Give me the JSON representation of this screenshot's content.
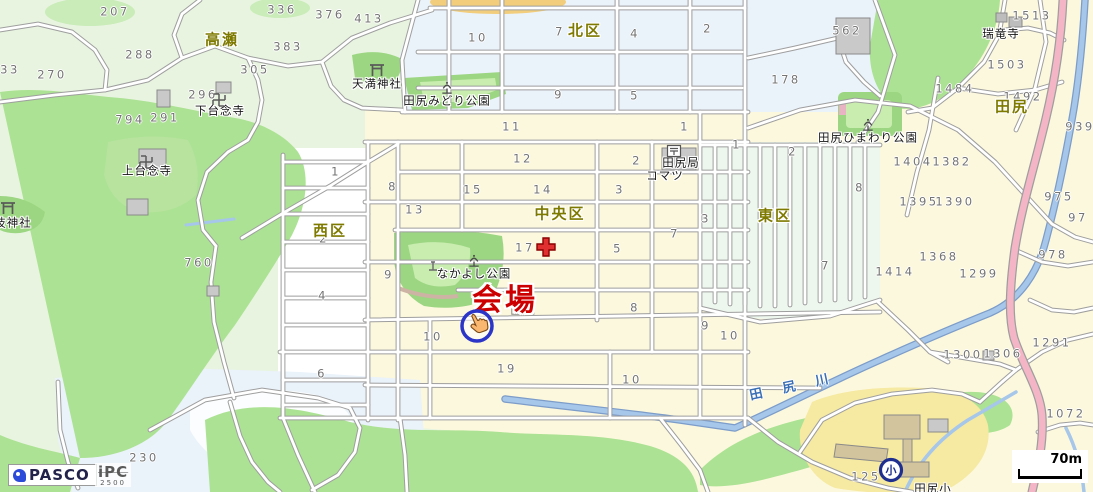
{
  "districts": [
    {
      "text": "高瀬",
      "x": 222,
      "y": 40
    },
    {
      "text": "北区",
      "x": 585,
      "y": 31
    },
    {
      "text": "西区",
      "x": 330,
      "y": 231
    },
    {
      "text": "中央区",
      "x": 560,
      "y": 214
    },
    {
      "text": "東区",
      "x": 775,
      "y": 216
    },
    {
      "text": "田尻",
      "x": 1012,
      "y": 107
    }
  ],
  "pois": [
    {
      "text": "田尻みどり公園",
      "x": 447,
      "y": 101
    },
    {
      "text": "天満神社",
      "x": 377,
      "y": 84
    },
    {
      "text": "下台念寺",
      "x": 220,
      "y": 111
    },
    {
      "text": "上台念寺",
      "x": 147,
      "y": 171
    },
    {
      "text": "技神社",
      "x": 13,
      "y": 223
    },
    {
      "text": "なかよし公園",
      "x": 474,
      "y": 274
    },
    {
      "text": "田尻ひまわり公園",
      "x": 868,
      "y": 138
    },
    {
      "text": "瑞竜寺",
      "x": 1001,
      "y": 34
    },
    {
      "text": "田尻局",
      "x": 681,
      "y": 163
    },
    {
      "text": "コマツ",
      "x": 665,
      "y": 176
    },
    {
      "text": "田尻小",
      "x": 933,
      "y": 489
    }
  ],
  "venue": {
    "label": "会場",
    "x": 505,
    "y": 301,
    "color": "#cc0000"
  },
  "river": {
    "label": "田 尻 川",
    "x": 793,
    "y": 387
  },
  "numbers": [
    {
      "t": "207",
      "x": 115,
      "y": 12
    },
    {
      "t": "336",
      "x": 282,
      "y": 10
    },
    {
      "t": "376",
      "x": 330,
      "y": 15
    },
    {
      "t": "413",
      "x": 369,
      "y": 19
    },
    {
      "t": "288",
      "x": 140,
      "y": 55
    },
    {
      "t": "383",
      "x": 288,
      "y": 47
    },
    {
      "t": "305",
      "x": 255,
      "y": 70
    },
    {
      "t": "270",
      "x": 52,
      "y": 75
    },
    {
      "t": "33",
      "x": 10,
      "y": 70
    },
    {
      "t": "296",
      "x": 203,
      "y": 95
    },
    {
      "t": "794",
      "x": 130,
      "y": 120
    },
    {
      "t": "291",
      "x": 165,
      "y": 118
    },
    {
      "t": "760",
      "x": 199,
      "y": 263
    },
    {
      "t": "230",
      "x": 144,
      "y": 458
    },
    {
      "t": "10",
      "x": 478,
      "y": 38
    },
    {
      "t": "7",
      "x": 560,
      "y": 32
    },
    {
      "t": "4",
      "x": 635,
      "y": 34
    },
    {
      "t": "2",
      "x": 708,
      "y": 29
    },
    {
      "t": "9",
      "x": 559,
      "y": 95
    },
    {
      "t": "5",
      "x": 635,
      "y": 96
    },
    {
      "t": "11",
      "x": 512,
      "y": 127
    },
    {
      "t": "1",
      "x": 685,
      "y": 127
    },
    {
      "t": "178",
      "x": 786,
      "y": 80
    },
    {
      "t": "562",
      "x": 847,
      "y": 31
    },
    {
      "t": "1513",
      "x": 1032,
      "y": 16
    },
    {
      "t": "1503",
      "x": 1007,
      "y": 65
    },
    {
      "t": "1484",
      "x": 955,
      "y": 89
    },
    {
      "t": "1492",
      "x": 1023,
      "y": 97
    },
    {
      "t": "939",
      "x": 1080,
      "y": 127
    },
    {
      "t": "12",
      "x": 523,
      "y": 159
    },
    {
      "t": "2",
      "x": 637,
      "y": 161
    },
    {
      "t": "15",
      "x": 473,
      "y": 190
    },
    {
      "t": "14",
      "x": 543,
      "y": 190
    },
    {
      "t": "3",
      "x": 620,
      "y": 190
    },
    {
      "t": "8",
      "x": 393,
      "y": 187
    },
    {
      "t": "13",
      "x": 415,
      "y": 210
    },
    {
      "t": "1",
      "x": 336,
      "y": 172
    },
    {
      "t": "2",
      "x": 324,
      "y": 239
    },
    {
      "t": "4",
      "x": 323,
      "y": 296
    },
    {
      "t": "9",
      "x": 389,
      "y": 275
    },
    {
      "t": "6",
      "x": 322,
      "y": 374
    },
    {
      "t": "17",
      "x": 525,
      "y": 248
    },
    {
      "t": "5",
      "x": 618,
      "y": 249
    },
    {
      "t": "7",
      "x": 675,
      "y": 234
    },
    {
      "t": "3",
      "x": 706,
      "y": 219
    },
    {
      "t": "8",
      "x": 635,
      "y": 308
    },
    {
      "t": "9",
      "x": 706,
      "y": 326
    },
    {
      "t": "10",
      "x": 433,
      "y": 337
    },
    {
      "t": "19",
      "x": 507,
      "y": 369
    },
    {
      "t": "10",
      "x": 632,
      "y": 380
    },
    {
      "t": "10",
      "x": 730,
      "y": 336
    },
    {
      "t": "1",
      "x": 737,
      "y": 145
    },
    {
      "t": "2",
      "x": 793,
      "y": 152
    },
    {
      "t": "8",
      "x": 860,
      "y": 188
    },
    {
      "t": "7",
      "x": 826,
      "y": 266
    },
    {
      "t": "1404",
      "x": 913,
      "y": 162
    },
    {
      "t": "1382",
      "x": 952,
      "y": 162
    },
    {
      "t": "1395",
      "x": 919,
      "y": 202
    },
    {
      "t": "1390",
      "x": 955,
      "y": 202
    },
    {
      "t": "1368",
      "x": 939,
      "y": 257
    },
    {
      "t": "1414",
      "x": 895,
      "y": 272
    },
    {
      "t": "1299",
      "x": 979,
      "y": 274
    },
    {
      "t": "975",
      "x": 1059,
      "y": 197
    },
    {
      "t": "97",
      "x": 1078,
      "y": 218
    },
    {
      "t": "978",
      "x": 1053,
      "y": 255
    },
    {
      "t": "1300",
      "x": 963,
      "y": 355
    },
    {
      "t": "1306",
      "x": 1003,
      "y": 354
    },
    {
      "t": "1291",
      "x": 1052,
      "y": 343
    },
    {
      "t": "1072",
      "x": 1066,
      "y": 414
    },
    {
      "t": "125",
      "x": 866,
      "y": 477
    }
  ],
  "boxed_numbers": [
    {
      "t": "16",
      "x": 523,
      "y": 307
    }
  ],
  "icons": [
    {
      "type": "torii",
      "x": 377,
      "y": 70
    },
    {
      "type": "torii",
      "x": 8,
      "y": 208
    },
    {
      "type": "manji",
      "x": 219,
      "y": 100
    },
    {
      "type": "manji",
      "x": 146,
      "y": 162
    },
    {
      "type": "park",
      "x": 447,
      "y": 88
    },
    {
      "type": "park",
      "x": 474,
      "y": 261
    },
    {
      "type": "park",
      "x": 868,
      "y": 125
    },
    {
      "type": "monument",
      "x": 433,
      "y": 266
    },
    {
      "type": "post",
      "x": 674,
      "y": 151
    },
    {
      "type": "cross",
      "x": 546,
      "y": 247
    },
    {
      "type": "school",
      "x": 891,
      "y": 470,
      "glyph": "小"
    }
  ],
  "scale_bar": {
    "label": "70m"
  },
  "logos": {
    "pasco": "PASCO",
    "ipc": "iPC",
    "ipc_sub": "2500"
  },
  "colors": {
    "district_label": "#7e7a00",
    "venue_red": "#cc0000",
    "river_blue": "#a6c6ea",
    "river_label_blue": "#3a6fb5",
    "residential_cream": "#fcf8dd",
    "forest_green": "#ace293",
    "highway_pink": "#f4b6c6",
    "school_yellow": "#f6e9a2",
    "north_block_blue": "#eaf2fa"
  }
}
